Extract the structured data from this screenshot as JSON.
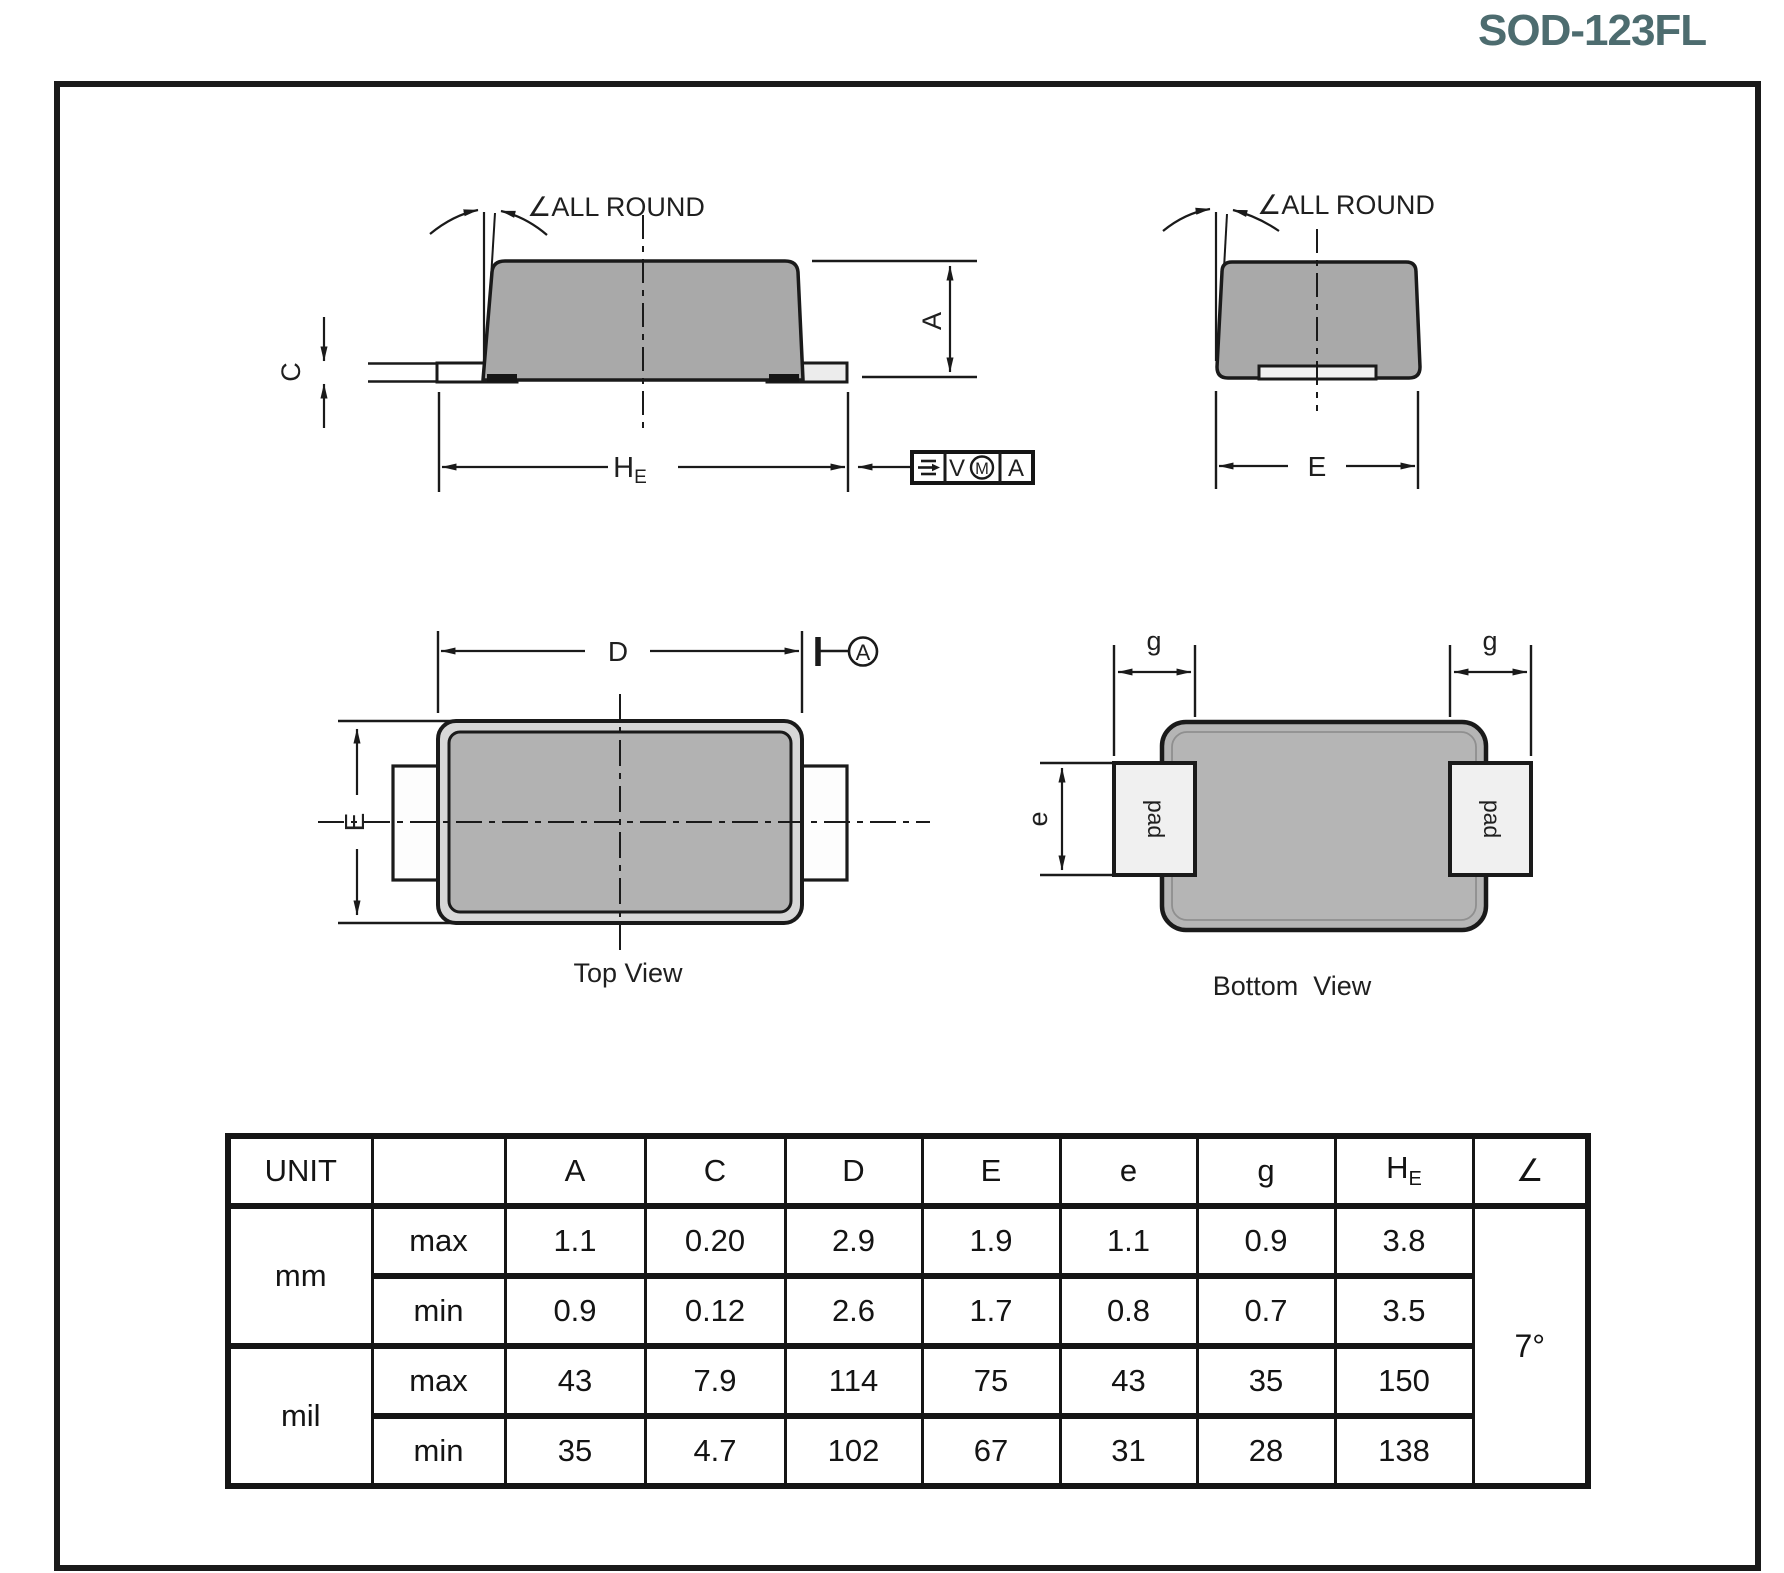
{
  "title": "SOD-123FL",
  "colors": {
    "accent": "#4D6C6F",
    "body_gray": "#A9A9A9",
    "pad_gray": "#F0F0F0",
    "line": "#1A1A1A"
  },
  "side_view": {
    "angle_note": "∠ALL ROUND",
    "dim_c": "C",
    "dim_a": "A",
    "he_base": "H",
    "he_sub": "E",
    "fcf_tolerance": "V",
    "fcf_modifier": "M",
    "fcf_datum": "A"
  },
  "end_view": {
    "angle_note": "∠ALL ROUND",
    "dim_e": "E"
  },
  "top_view": {
    "label": "Top View",
    "dim_d": "D",
    "dim_e": "E",
    "datum": "A"
  },
  "bottom_view": {
    "label": "Bottom  View",
    "dim_g_left": "g",
    "dim_g_right": "g",
    "dim_e": "e",
    "pad_left_label": "pad",
    "pad_right_label": "pad"
  },
  "table": {
    "headers": {
      "unit": "UNIT",
      "sub": "",
      "a": "A",
      "c": "C",
      "d": "D",
      "e_upper": "E",
      "e_lower": "e",
      "g": "g",
      "he_base": "H",
      "he_sub": "E",
      "angle": "∠"
    },
    "row_groups": [
      {
        "unit": "mm",
        "rows": [
          {
            "bound": "max",
            "values": [
              "1.1",
              "0.20",
              "2.9",
              "1.9",
              "1.1",
              "0.9",
              "3.8"
            ]
          },
          {
            "bound": "min",
            "values": [
              "0.9",
              "0.12",
              "2.6",
              "1.7",
              "0.8",
              "0.7",
              "3.5"
            ]
          }
        ]
      },
      {
        "unit": "mil",
        "rows": [
          {
            "bound": "max",
            "values": [
              "43",
              "7.9",
              "114",
              "75",
              "43",
              "35",
              "150"
            ]
          },
          {
            "bound": "min",
            "values": [
              "35",
              "4.7",
              "102",
              "67",
              "31",
              "28",
              "138"
            ]
          }
        ]
      }
    ],
    "angle_value": "7°"
  }
}
